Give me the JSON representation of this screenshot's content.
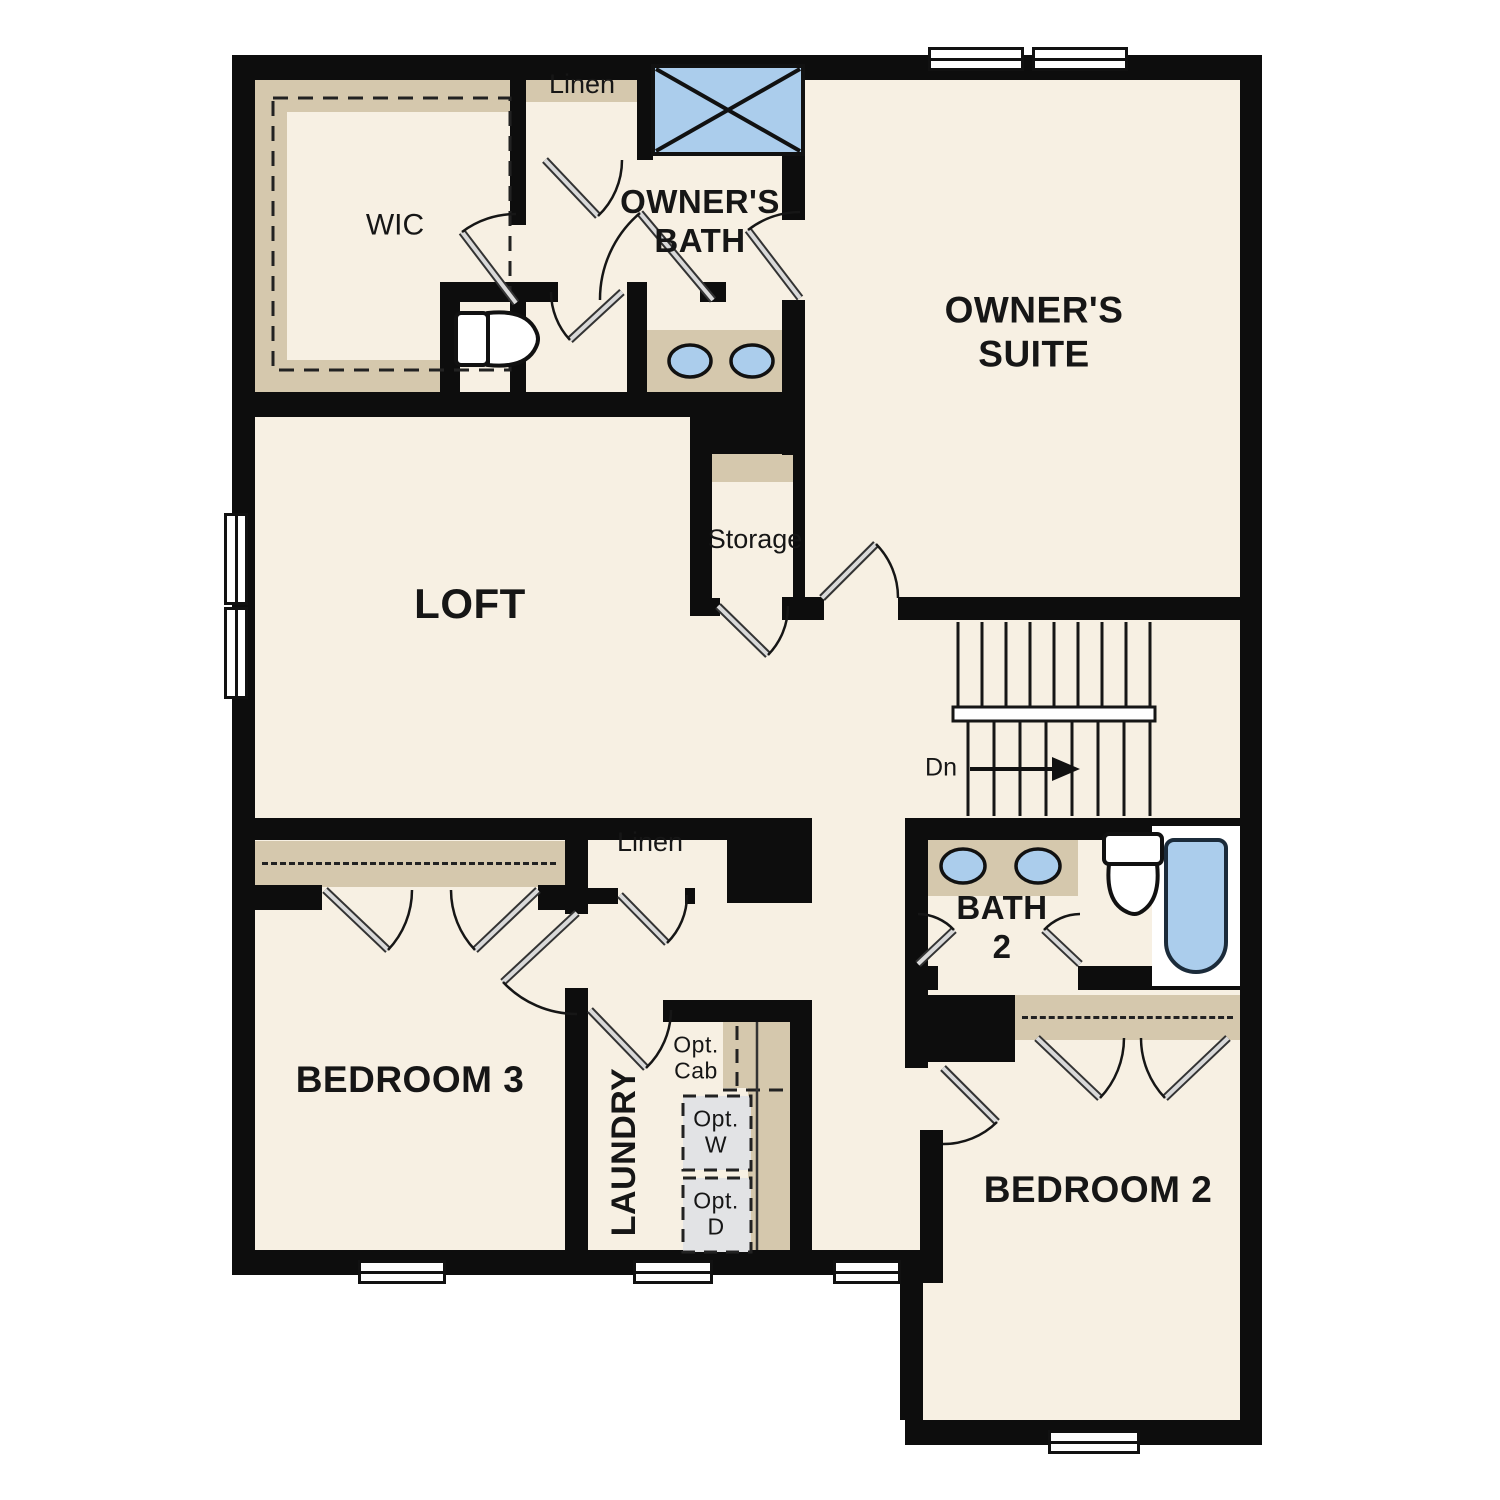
{
  "title": "Second Floor Plan",
  "colors": {
    "wall": "#0d0d0d",
    "floor": "#f7f0e3",
    "cabinet": "#d5c8ad",
    "fixture": "#abcdec",
    "appliance": "#e2e3e5"
  },
  "rooms": {
    "wic": "WIC",
    "linen_upper": "Linen",
    "owners_bath": "OWNER'S\nBATH",
    "owners_suite": "OWNER'S\nSUITE",
    "storage": "Storage",
    "loft": "LOFT",
    "dn": "Dn",
    "bath2": "BATH\n2",
    "bedroom3": "BEDROOM 3",
    "linen_lower": "Linen",
    "laundry": "LAUNDRY",
    "opt_cab": "Opt.\nCab",
    "opt_w": "Opt.\nW",
    "opt_d": "Opt.\nD",
    "bedroom2": "BEDROOM 2"
  }
}
